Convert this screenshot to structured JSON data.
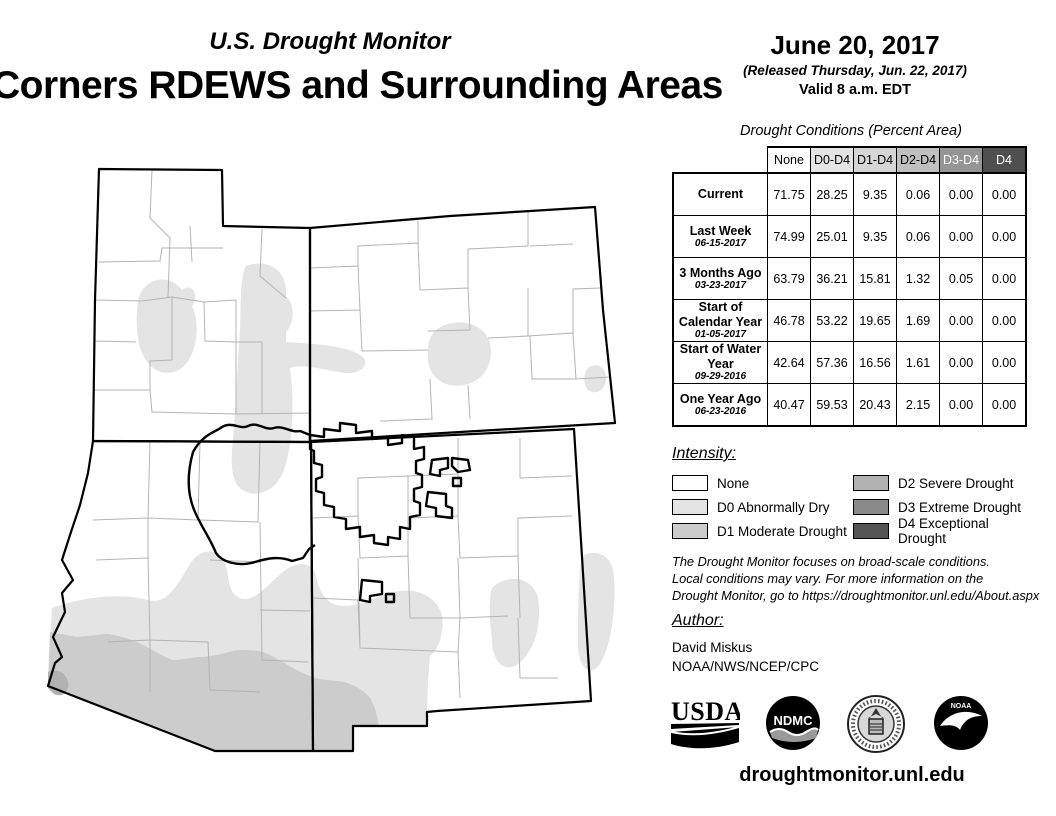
{
  "header": {
    "monitor_title": "U.S. Drought Monitor",
    "map_title": "Corners RDEWS and Surrounding Areas",
    "date": "June 20, 2017",
    "released": "(Released Thursday, Jun. 22, 2017)",
    "valid": "Valid 8 a.m. EDT"
  },
  "table": {
    "title": "Drought Conditions (Percent Area)",
    "columns": [
      "None",
      "D0-D4",
      "D1-D4",
      "D2-D4",
      "D3-D4",
      "D4"
    ],
    "column_colors": [
      "#ffffff",
      "#e4e4e4",
      "#d6d6d6",
      "#c0c0c0",
      "#959595",
      "#4f4f4f"
    ],
    "rows": [
      {
        "label": "Current",
        "date": "",
        "values": [
          "71.75",
          "28.25",
          "9.35",
          "0.06",
          "0.00",
          "0.00"
        ]
      },
      {
        "label": "Last Week",
        "date": "06-15-2017",
        "values": [
          "74.99",
          "25.01",
          "9.35",
          "0.06",
          "0.00",
          "0.00"
        ]
      },
      {
        "label": "3 Months Ago",
        "date": "03-23-2017",
        "values": [
          "63.79",
          "36.21",
          "15.81",
          "1.32",
          "0.05",
          "0.00"
        ]
      },
      {
        "label": "Start of Calendar Year",
        "date": "01-05-2017",
        "values": [
          "46.78",
          "53.22",
          "19.65",
          "1.69",
          "0.00",
          "0.00"
        ]
      },
      {
        "label": "Start of Water Year",
        "date": "09-29-2016",
        "values": [
          "42.64",
          "57.36",
          "16.56",
          "1.61",
          "0.00",
          "0.00"
        ]
      },
      {
        "label": "One Year Ago",
        "date": "06-23-2016",
        "values": [
          "40.47",
          "59.53",
          "20.43",
          "2.15",
          "0.00",
          "0.00"
        ]
      }
    ]
  },
  "legend": {
    "title": "Intensity:",
    "items": [
      {
        "label": "None",
        "color": "#ffffff"
      },
      {
        "label": "D0 Abnormally Dry",
        "color": "#e4e4e4"
      },
      {
        "label": "D1 Moderate Drought",
        "color": "#cccccc"
      },
      {
        "label": "D2 Severe Drought",
        "color": "#b2b2b2"
      },
      {
        "label": "D3 Extreme Drought",
        "color": "#8a8a8a"
      },
      {
        "label": "D4 Exceptional Drought",
        "color": "#555555"
      }
    ]
  },
  "disclaimer_lines": [
    "The Drought Monitor focuses on broad-scale conditions.",
    "Local conditions may vary. For more information on the",
    "Drought Monitor, go to https://droughtmonitor.unl.edu/About.aspx"
  ],
  "author": {
    "title": "Author:",
    "name": "David Miskus",
    "org": "NOAA/NWS/NCEP/CPC"
  },
  "footer": {
    "url": "droughtmonitor.unl.edu",
    "logos": [
      "USDA",
      "NDMC",
      "Department of Commerce",
      "NOAA"
    ]
  },
  "logo_text": {
    "usda": "USDA",
    "ndmc": "NDMC",
    "noaa": "NOAA"
  }
}
